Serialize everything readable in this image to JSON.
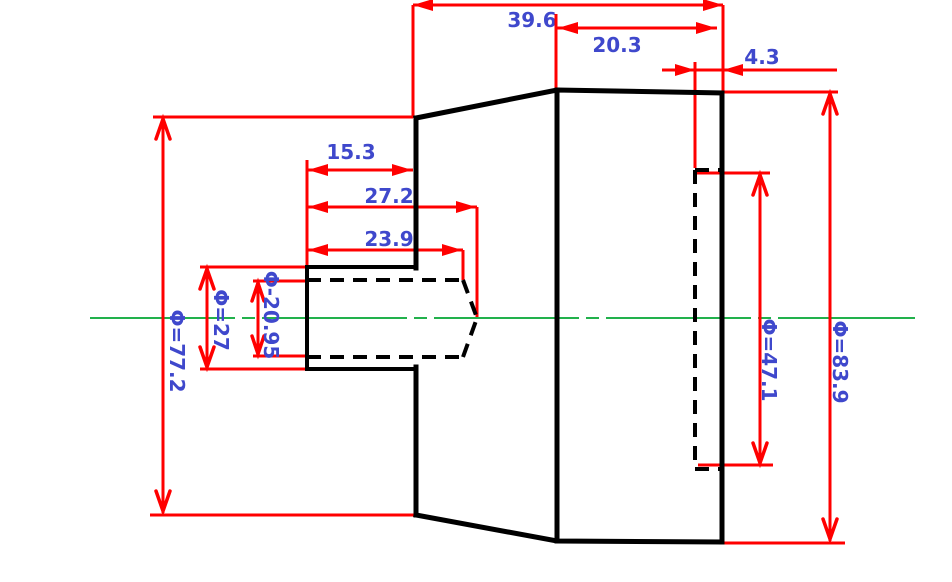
{
  "drawing": {
    "type": "engineering-dimension-drawing",
    "part": "stepped shaft with tapered flange, hidden drilled hole (left) and hidden bore (right)",
    "colors": {
      "background": "#ffffff",
      "outline": "#000000",
      "dimension": "#ff0000",
      "label": "#3f48cc",
      "centerline": "#22b14c"
    },
    "labels": {
      "d39_6": "39.6",
      "d20_3": "20.3",
      "d4_3": "4.3",
      "d15_3": "15.3",
      "d27_2": "27.2",
      "d23_9": "23.9",
      "dia77_2": "Φ=77.2",
      "dia27": "Φ=27",
      "dia20_95": "Φ-20.95",
      "dia47_1": "Φ=47.1",
      "dia83_9": "Φ=83.9"
    },
    "values": {
      "lengths": [
        39.6,
        20.3,
        4.3,
        15.3,
        27.2,
        23.9
      ],
      "diameters": [
        77.2,
        27,
        20.95,
        47.1,
        83.9
      ]
    }
  }
}
